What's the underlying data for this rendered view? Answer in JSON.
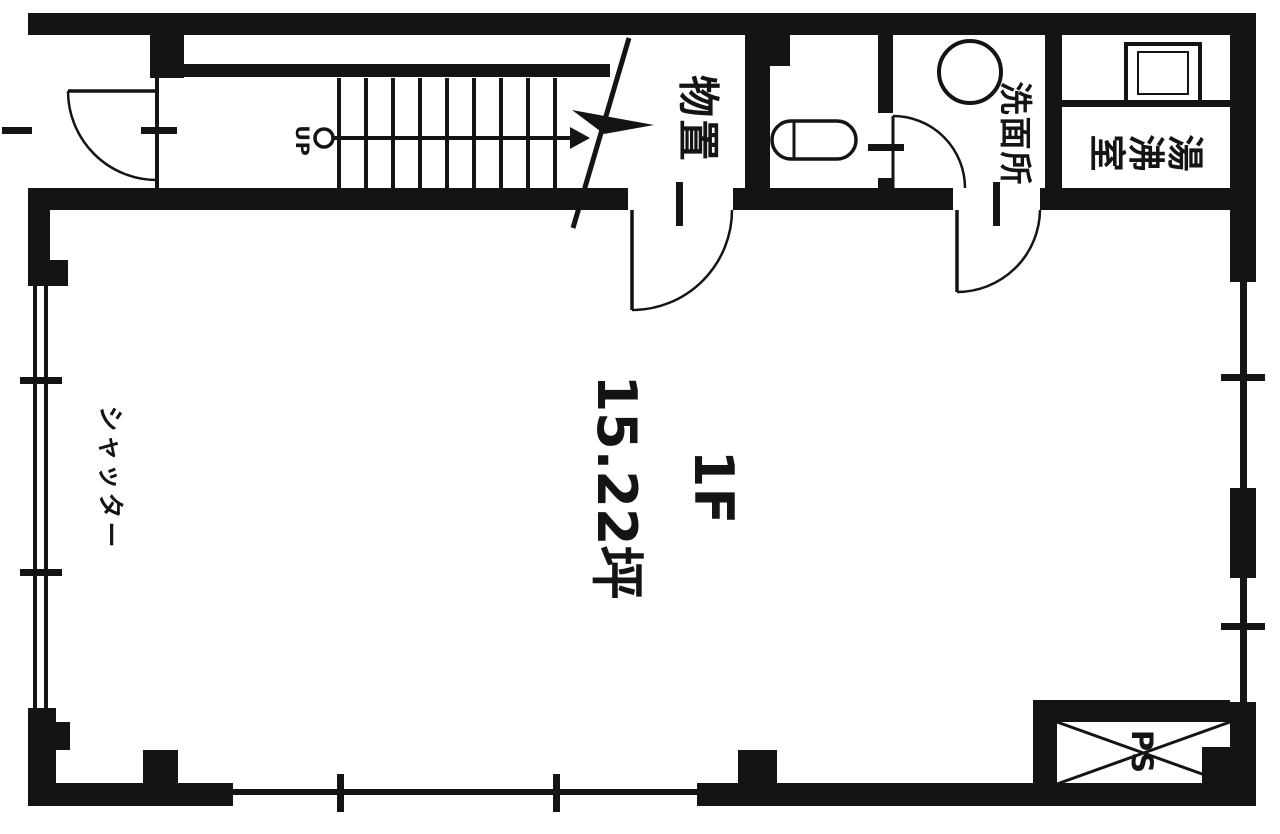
{
  "plan": {
    "floor_label": "1F",
    "area_label": "15.22坪",
    "rooms": {
      "storage": "物置",
      "washroom": "洗面所",
      "water_heater_room": "湯沸室"
    },
    "annotations": {
      "shutter": "シャッター",
      "stairs_direction": "UP",
      "pipe_space": "PS"
    },
    "colors": {
      "ink": "#141414",
      "background": "#ffffff"
    }
  }
}
